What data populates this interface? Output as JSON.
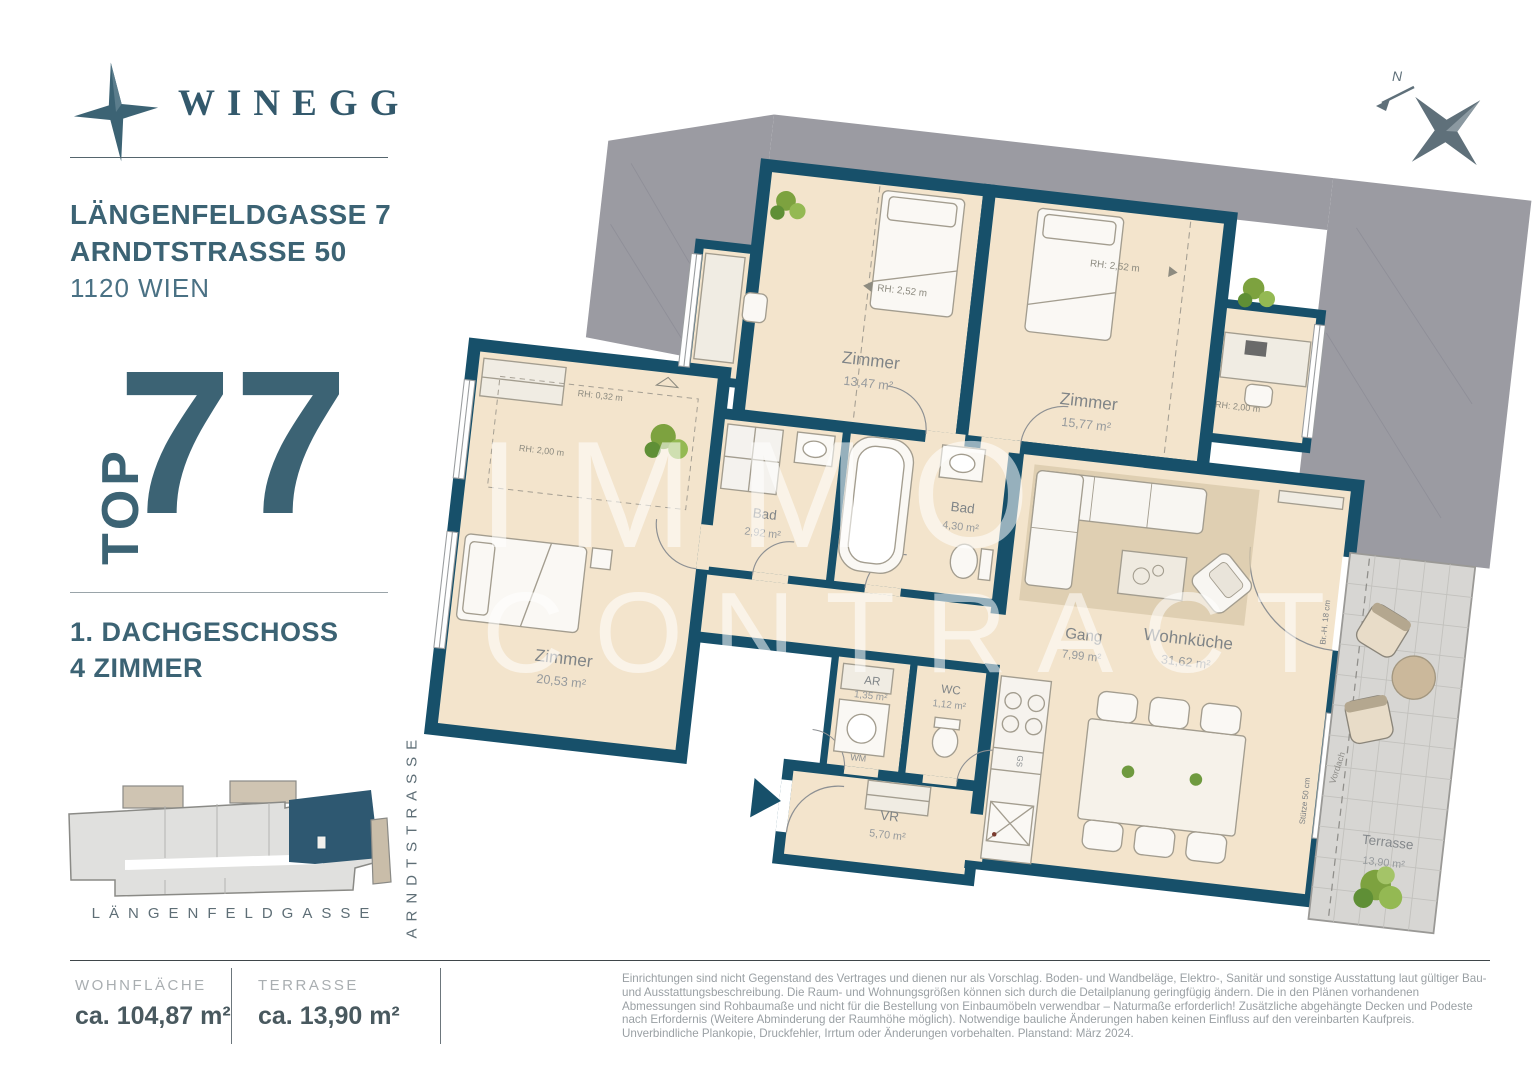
{
  "brand": {
    "name": "WINEGG"
  },
  "header": {
    "address_line1": "LÄNGENFELDGASSE 7",
    "address_line2": "ARNDTSTRASSE 50",
    "address_city": "1120 WIEN"
  },
  "unit": {
    "top_label": "TOP",
    "top_number": "77",
    "floor": "1. DACHGESCHOSS",
    "rooms": "4 ZIMMER"
  },
  "site_plan": {
    "street_bottom": "LÄNGENFELDGASSE",
    "street_right": "ARNDTSTRASSE"
  },
  "metrics": [
    {
      "label": "WOHNFLÄCHE",
      "value": "ca. 104,87 m²"
    },
    {
      "label": "TERRASSE",
      "value": "ca. 13,90 m²"
    }
  ],
  "disclaimer": "Einrichtungen sind nicht Gegenstand des Vertrages und dienen nur als Vorschlag. Boden- und Wandbeläge, Elektro-, Sanitär und sonstige Ausstattung laut gültiger Bau- und Ausstattungsbeschreibung. Die Raum- und Wohnungsgrößen können sich durch die Detailplanung geringfügig ändern. Die in den Plänen vorhandenen Abmessungen sind Rohbaumaße und nicht für die Bestellung von Einbaumöbeln verwendbar – Naturmaße erforderlich! Zusätzliche abgehängte Decken und Podeste nach Erfordernis (Weitere Abminderung der Raumhöhe möglich). Notwendige bauliche Änderungen haben keinen Einfluss auf den vereinbarten Kaufpreis. Unverbindliche Plankopie, Druckfehler, Irrtum oder Änderungen vorbehalten. Planstand: März 2024.",
  "watermark": {
    "line1": "IMMO",
    "line2": "CONTRACT"
  },
  "compass": {
    "north": "N"
  },
  "floorplan": {
    "rooms": {
      "zimmer1": {
        "name": "Zimmer",
        "area": "13,47 m²"
      },
      "zimmer2": {
        "name": "Zimmer",
        "area": "15,77 m²"
      },
      "bad1": {
        "name": "Bad",
        "area": "2,92 m²"
      },
      "bad2": {
        "name": "Bad",
        "area": "4,30 m²"
      },
      "gang": {
        "name": "Gang",
        "area": "7,99 m²"
      },
      "ar": {
        "name": "AR",
        "area": "1,35 m²"
      },
      "wc": {
        "name": "WC",
        "area": "1,12 m²"
      },
      "zimmer3": {
        "name": "Zimmer",
        "area": "20,53 m²"
      },
      "vr": {
        "name": "VR",
        "area": "5,70 m²"
      },
      "wohnkueche": {
        "name": "Wohnküche",
        "area": "31,62 m²"
      },
      "terrasse": {
        "name": "Terrasse",
        "area": "13,90 m²"
      }
    },
    "annotations": {
      "rh_252_a": "RH: 2,52 m",
      "rh_252_b": "RH: 2,52 m",
      "rh_200_a": "RH: 2,00 m",
      "rh_032": "RH: 0,32 m",
      "rh_200_b": "RH: 2,00 m",
      "wm": "WM",
      "gs": "GS",
      "vordach": "Vordach",
      "stuetze": "Stütze 50 cm",
      "bruestung": "Br.-H. 18 cm"
    },
    "colors": {
      "wall": "#17506a",
      "floor": "#f3e4cc",
      "roof_gray": "#9b9ba2",
      "terrace_gray": "#d7d6d3",
      "accent_text": "#3c6374",
      "site_highlight": "#2e5871"
    }
  }
}
